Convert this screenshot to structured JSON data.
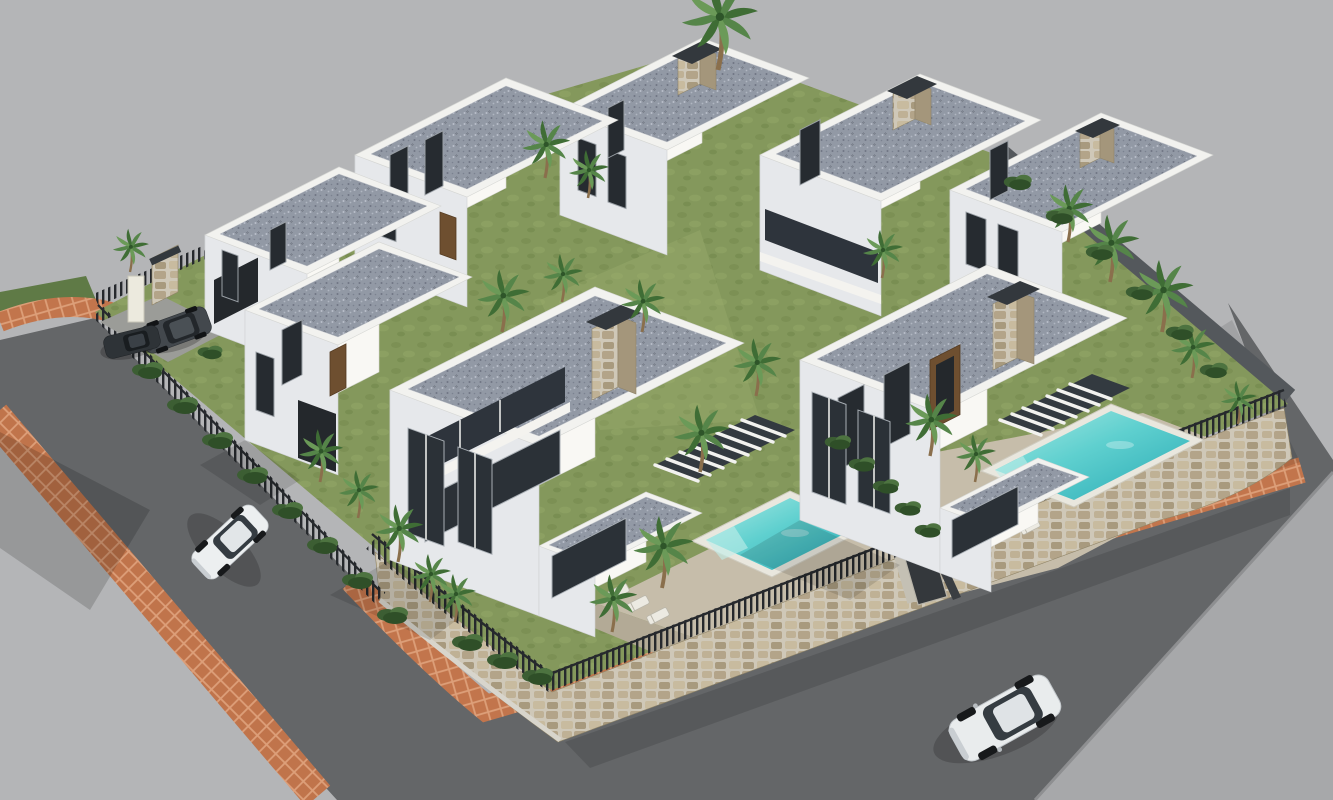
{
  "meta": {
    "title": "Aerial 3D render — modern villa development with pools",
    "type": "architectural-visualization",
    "view": "high-angle isometric aerial"
  },
  "scene": {
    "description": "Gated residential development of modern white two-storey villas with flat gravel roofs, stone-clad chimneys with anthracite caps, private turquoise pools on beige terraces, palm gardens, stone perimeter wall topped by dark picket fencing, asphalt roads edged with terracotta brick sidewalks, and four cars.",
    "counts": {
      "villas": 8,
      "pools": 2,
      "cars": 4,
      "palm_trees": 24,
      "pergolas": 2
    },
    "cars": [
      {
        "name": "white-suv",
        "location": "bottom road, driving"
      },
      {
        "name": "white-hatchback",
        "location": "left road, parked"
      },
      {
        "name": "dark-suv",
        "location": "entrance driveway"
      },
      {
        "name": "dark-sedan",
        "location": "entrance, beside driveway"
      }
    ],
    "landmarks": [
      "back row of five villas along the skyline",
      "two large front villas with private pools",
      "rounded stone wall corner at lower right",
      "site entrance with gate pillars at upper left"
    ]
  },
  "palette": {
    "background": "#b4b5b7",
    "road": "#646668",
    "road_far": "#a7a8aa",
    "curb": "#8e8f91",
    "sidewalk_brick": "#c0744b",
    "sidewalk_mortar": "#dd9f79",
    "stone_wall": "#b3a489",
    "stone_mortar": "#cfc8b8",
    "grass": "#84985c",
    "grass_shade": "#65804a",
    "terrace": "#c6bdaa",
    "wall_white": "#f9f8f4",
    "wall_shade": "#e6e8eb",
    "roof_gravel": "#9299a5",
    "roof_parapet": "#f2f2ef",
    "accent_dark": "#33383d",
    "fence_dark": "#26292d",
    "wood": "#6e4f30",
    "pool_light": "#a9e9e3",
    "pool_mid": "#5fd0cf",
    "pool_water": "#28a9b4",
    "pool_coping": "#e9e7de",
    "car_white": "#e9eced",
    "car_dark": "#43484d",
    "palm_green": "#4f7a40",
    "palm_trunk": "#8a6f4c"
  }
}
